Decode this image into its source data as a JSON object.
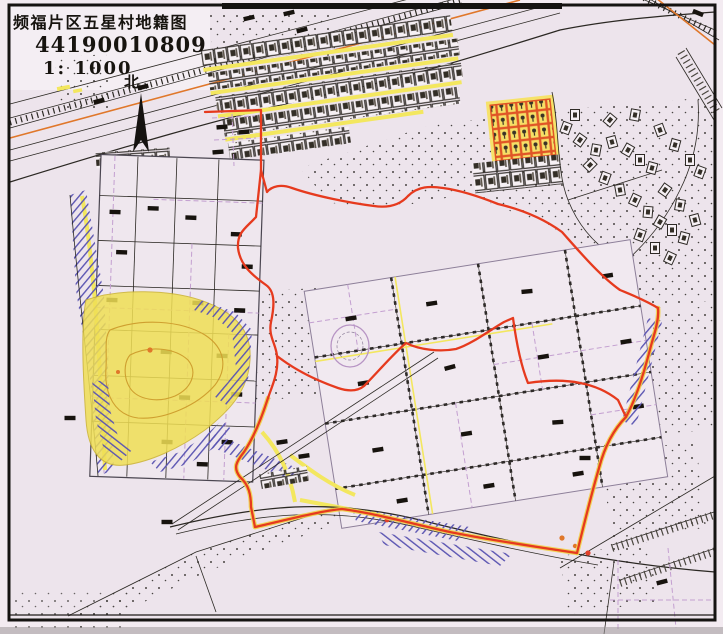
{
  "title_block": {
    "map_title": "频福片区五星村地籍图",
    "sheet_number": "44190010809",
    "scale_label": "1: 1000",
    "north_label": "北"
  },
  "colors": {
    "margin_paper": "#f3ebf1",
    "map_paper": "#ede4ec",
    "frame_ink": "#151311",
    "line_ink": "#2b2823",
    "boundary_red": "#e63a1e",
    "halo_yellow": "#f1d24a",
    "road_yellow": "#f3e75f",
    "hill_yellow": "#f0df55",
    "hachure_purple": "#5b55b2",
    "parcel_purple": "#c39fd0",
    "accent_orange": "#e0772a",
    "house_fill": "#f6f0f4",
    "dot_ink": "#2d2a26"
  }
}
